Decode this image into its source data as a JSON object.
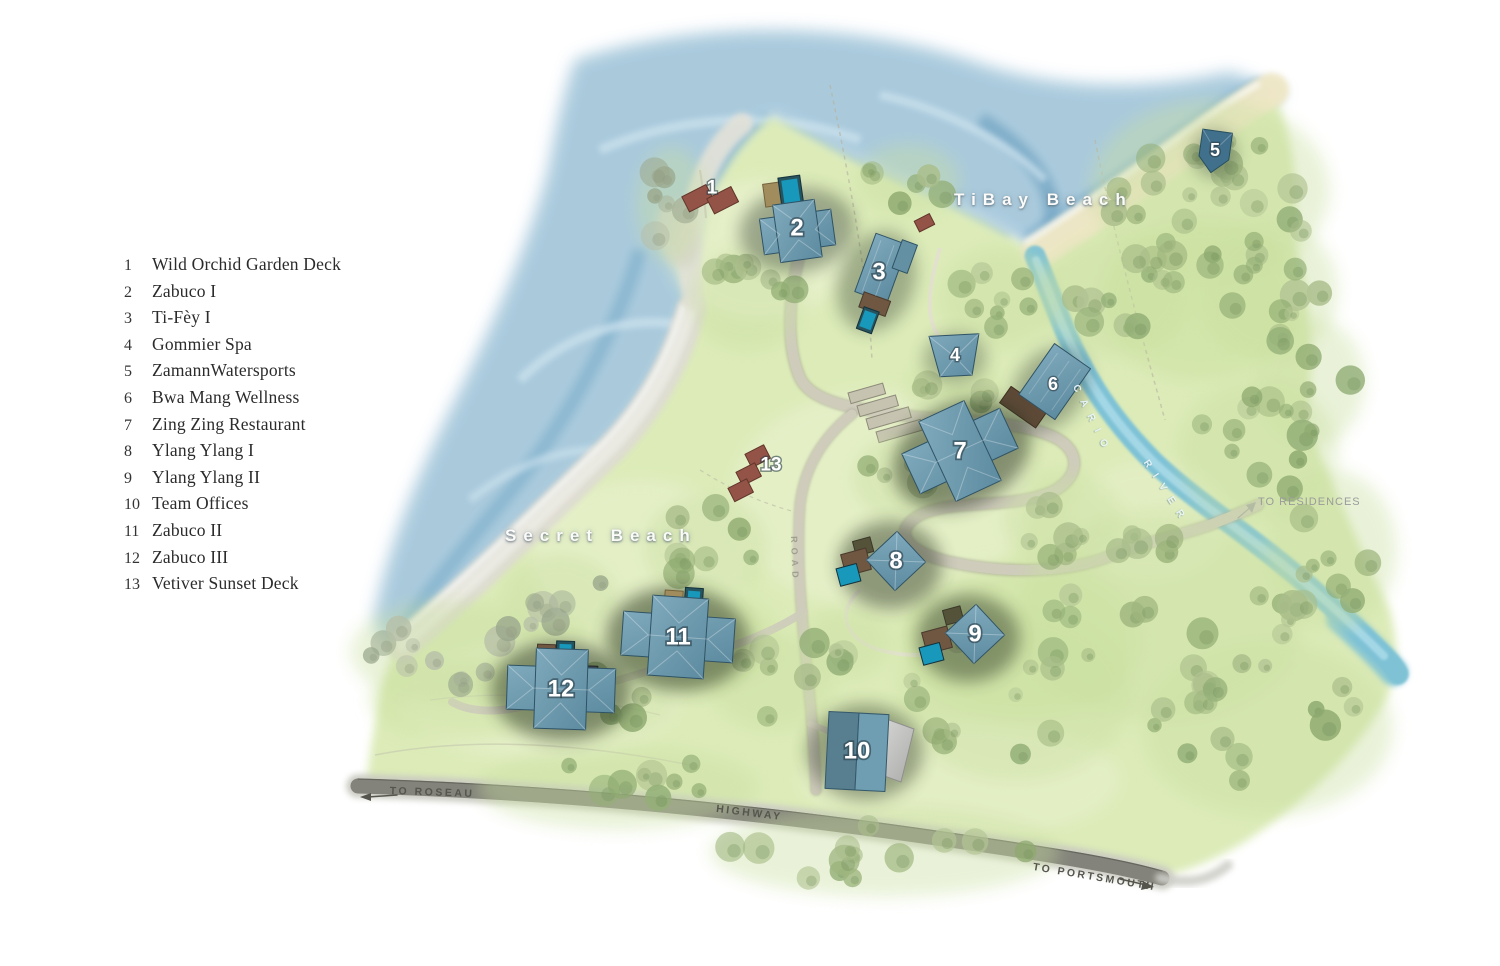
{
  "legend": {
    "items": [
      {
        "num": "1",
        "label": "Wild Orchid Garden Deck"
      },
      {
        "num": "2",
        "label": "Zabuco I"
      },
      {
        "num": "3",
        "label": "Ti-Fèy I"
      },
      {
        "num": "4",
        "label": "Gommier Spa"
      },
      {
        "num": "5",
        "label": "ZamannWatersports"
      },
      {
        "num": "6",
        "label": "Bwa Mang Wellness"
      },
      {
        "num": "7",
        "label": "Zing Zing Restaurant"
      },
      {
        "num": "8",
        "label": "Ylang Ylang I"
      },
      {
        "num": "9",
        "label": "Ylang Ylang II"
      },
      {
        "num": "10",
        "label": "Team Offices"
      },
      {
        "num": "11",
        "label": "Zabuco II"
      },
      {
        "num": "12",
        "label": "Zabuco III"
      },
      {
        "num": "13",
        "label": "Vetiver Sunset Deck"
      }
    ]
  },
  "map": {
    "labels": {
      "tibay_beach": "TiBay Beach",
      "secret_beach": "Secret Beach",
      "river_word1": "CARIO",
      "river_word2": "RIVER",
      "road_vertical": "ROAD",
      "to_roseau": "TO ROSEAU",
      "highway": "HIGHWAY",
      "to_portsmouth": "TO PORTSMOUTH",
      "to_residences": "TO RESIDENCES"
    },
    "markers": [
      {
        "num": "1",
        "name": "Wild Orchid Garden Deck",
        "x": 712,
        "y": 188,
        "size": "sm"
      },
      {
        "num": "2",
        "name": "Zabuco I",
        "x": 797,
        "y": 228,
        "size": "lg"
      },
      {
        "num": "3",
        "name": "Ti-Fèy I",
        "x": 879,
        "y": 272,
        "size": "lg"
      },
      {
        "num": "4",
        "name": "Gommier Spa",
        "x": 955,
        "y": 355,
        "size": "md"
      },
      {
        "num": "5",
        "name": "ZamannWatersports",
        "x": 1215,
        "y": 150,
        "size": "md"
      },
      {
        "num": "6",
        "name": "Bwa Mang Wellness",
        "x": 1053,
        "y": 384,
        "size": "md"
      },
      {
        "num": "7",
        "name": "Zing Zing Restaurant",
        "x": 960,
        "y": 451,
        "size": "lg"
      },
      {
        "num": "8",
        "name": "Ylang Ylang I",
        "x": 896,
        "y": 561,
        "size": "lg"
      },
      {
        "num": "9",
        "name": "Ylang Ylang II",
        "x": 975,
        "y": 634,
        "size": "lg"
      },
      {
        "num": "10",
        "name": "Team Offices",
        "x": 857,
        "y": 751,
        "size": "lg"
      },
      {
        "num": "11",
        "name": "Zabuco II",
        "x": 678,
        "y": 637,
        "size": "lg"
      },
      {
        "num": "12",
        "name": "Zabuco III",
        "x": 561,
        "y": 689,
        "size": "lg"
      },
      {
        "num": "13",
        "name": "Vetiver Sunset Deck",
        "x": 771,
        "y": 465,
        "size": "sm"
      }
    ],
    "colors": {
      "sea": "#a3c6da",
      "sand": "#efe7c6",
      "beach_gray": "#dedcd2",
      "land": "#dcebb8",
      "river": "#7fc2d6",
      "roof": "#6f9db1",
      "pool": "#1898ba",
      "deck_brown": "#6f5742",
      "deck_tan": "#a18c5e",
      "deck_red": "#935346",
      "highway": "#83837b",
      "trail": "#cfccbc"
    }
  }
}
